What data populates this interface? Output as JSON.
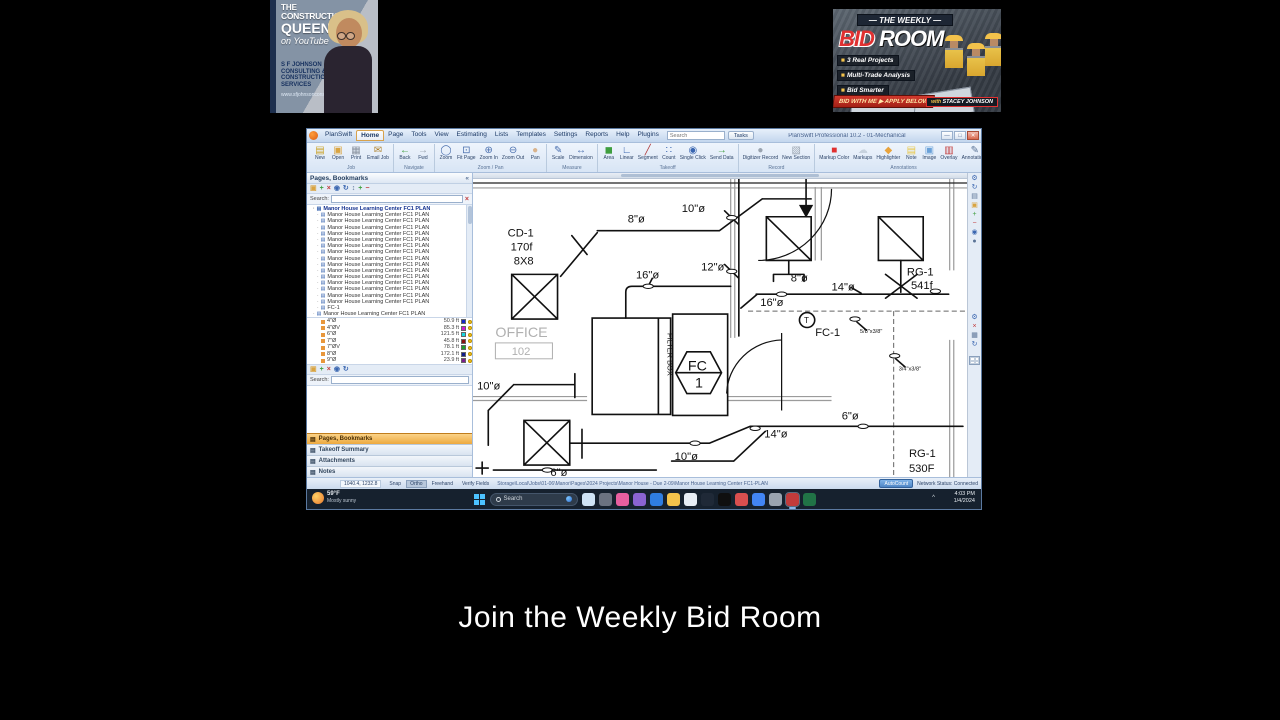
{
  "overlay": {
    "caption": "Join the Weekly Bid Room",
    "brand_card": {
      "the": "THE",
      "construction": "CONSTRUCTION",
      "queen": "QUEEN",
      "on_youtube": "on YouTube",
      "company_lines": [
        "S F JOHNSON",
        "CONSULTING &",
        "CONSTRUCTION",
        "SERVICES"
      ],
      "website": "www.sfjohnsonconsulting.com"
    },
    "banner": {
      "top": "— THE WEEKLY —",
      "title_red": "BID",
      "title_white": " ROOM",
      "bullets": [
        "3 Real Projects",
        "Multi-Trade Analysis",
        "Bid Smarter"
      ],
      "cta": "BID WITH ME  ▶ APPLY BELOW",
      "host_prefix": "with ",
      "host_name": "STACEY JOHNSON"
    }
  },
  "app": {
    "window_title": "PlanSwift Professional 10.2 - 01-Mechanical",
    "window_controls": {
      "minimize": "—",
      "maximize": "□",
      "close": "✕"
    },
    "menu": {
      "tabs": [
        "PlanSwift",
        "Home",
        "Page",
        "Tools",
        "View",
        "Estimating",
        "Lists",
        "Templates",
        "Settings",
        "Reports",
        "Help",
        "Plugins"
      ],
      "active_tab": "Home",
      "search_placeholder": "Search",
      "tasks_button": "Tasks"
    },
    "ribbon": {
      "groups": [
        {
          "label": "Job",
          "items": [
            {
              "label": "New",
              "glyph": "▤",
              "color": "#c9a227"
            },
            {
              "label": "Open",
              "glyph": "▣",
              "color": "#d9a441"
            },
            {
              "label": "Print",
              "glyph": "▦",
              "color": "#8a93a0"
            },
            {
              "label": "Email Job",
              "glyph": "✉",
              "color": "#b08430"
            }
          ]
        },
        {
          "label": "Navigate",
          "items": [
            {
              "label": "Back",
              "glyph": "←",
              "color": "#3f9e3f"
            },
            {
              "label": "Fwd",
              "glyph": "→",
              "color": "#9aa4b0"
            }
          ]
        },
        {
          "label": "Zoom / Pan",
          "items": [
            {
              "label": "Zoom",
              "glyph": "◯",
              "color": "#4a6fae"
            },
            {
              "label": "Fit Page",
              "glyph": "⊡",
              "color": "#4a6fae"
            },
            {
              "label": "Zoom In",
              "glyph": "⊕",
              "color": "#4a6fae"
            },
            {
              "label": "Zoom Out",
              "glyph": "⊖",
              "color": "#4a6fae"
            },
            {
              "label": "Pan",
              "glyph": "●",
              "color": "#d9b38c"
            }
          ]
        },
        {
          "label": "Measure",
          "items": [
            {
              "label": "Scale",
              "glyph": "✎",
              "color": "#4a6fae"
            },
            {
              "label": "Dimension",
              "glyph": "↔",
              "color": "#4a6fae"
            }
          ]
        },
        {
          "label": "Takeoff",
          "items": [
            {
              "label": "Area",
              "glyph": "◼",
              "color": "#3f9e3f"
            },
            {
              "label": "Linear",
              "glyph": "∟",
              "color": "#3a66b0"
            },
            {
              "label": "Segment",
              "glyph": "╱",
              "color": "#b03a3a"
            },
            {
              "label": "Count",
              "glyph": "∷",
              "color": "#3a66b0"
            },
            {
              "label": "Single Click",
              "glyph": "◉",
              "color": "#3a66b0"
            },
            {
              "label": "Send Data",
              "glyph": "→",
              "color": "#3f9e3f"
            }
          ]
        },
        {
          "label": "Record",
          "items": [
            {
              "label": "Digitizer Record",
              "glyph": "●",
              "color": "#9aa4b0"
            },
            {
              "label": "New Section",
              "glyph": "▧",
              "color": "#9aa4b0"
            }
          ]
        },
        {
          "label": "Annotations",
          "items": [
            {
              "label": "Markup Color",
              "glyph": "■",
              "color": "#e03030"
            },
            {
              "label": "Markups",
              "glyph": "☁",
              "color": "#c7d2de"
            },
            {
              "label": "Highlighter",
              "glyph": "◆",
              "color": "#e8a33d"
            },
            {
              "label": "Note",
              "glyph": "▤",
              "color": "#e8c84a"
            },
            {
              "label": "Image",
              "glyph": "▣",
              "color": "#6aa1d8"
            },
            {
              "label": "Overlay",
              "glyph": "▥",
              "color": "#c23b3b"
            },
            {
              "label": "Annotations",
              "glyph": "✎",
              "color": "#5a7396"
            }
          ]
        }
      ]
    },
    "sidebar": {
      "header": "Pages, Bookmarks",
      "toolbar_icons": [
        {
          "name": "folder-icon",
          "glyph": "▣",
          "color": "#d9a441"
        },
        {
          "name": "add-icon",
          "glyph": "+",
          "color": "#3f9e3f"
        },
        {
          "name": "delete-icon",
          "glyph": "×",
          "color": "#c23b3b"
        },
        {
          "name": "record-icon",
          "glyph": "◉",
          "color": "#3a66b0"
        },
        {
          "name": "refresh-icon",
          "glyph": "↻",
          "color": "#3a66b0"
        },
        {
          "name": "sort-icon",
          "glyph": "↕",
          "color": "#5a7396"
        },
        {
          "name": "expand-all-icon",
          "glyph": "+",
          "color": "#3f9e3f"
        },
        {
          "name": "collapse-all-icon",
          "glyph": "−",
          "color": "#c23b3b"
        }
      ],
      "search_label": "Search:",
      "selected_page": "Manor House Learning Center FC1 PLAN",
      "page_item_label": "Manor House Learning Center FC1 PLAN",
      "page_item_repeat": 15,
      "extra_page": "FC-1",
      "expanded_page": "Manor House Learning Center FC1 PLAN",
      "takeoff_items": [
        {
          "name": "4\"Ø",
          "qty": "50.9 ft",
          "color": "#1626c9"
        },
        {
          "name": "4\"ØV",
          "qty": "85.3 ft",
          "color": "#d019d0"
        },
        {
          "name": "6\"Ø",
          "qty": "121.5 ft",
          "color": "#17d6e0"
        },
        {
          "name": "7\"Ø",
          "qty": "45.8 ft",
          "color": "#8b1010"
        },
        {
          "name": "7\"ØV",
          "qty": "78.1 ft",
          "color": "#1f9e28"
        },
        {
          "name": "8\"Ø",
          "qty": "172.1 ft",
          "color": "#101c8c"
        },
        {
          "name": "9\"Ø",
          "qty": "23.9 ft",
          "color": "#7c1c8c"
        }
      ],
      "panels": [
        "Pages, Bookmarks",
        "Takeoff Summary",
        "Attachments",
        "Notes"
      ],
      "active_panel": "Pages, Bookmarks"
    },
    "right_toolbar": {
      "top": [
        {
          "name": "settings-icon",
          "glyph": "⚙",
          "color": "#3a66b0"
        },
        {
          "name": "refresh-icon",
          "glyph": "↻",
          "color": "#3a66b0"
        },
        {
          "name": "new-page-icon",
          "glyph": "▤",
          "color": "#5a7396"
        },
        {
          "name": "folder-icon",
          "glyph": "▣",
          "color": "#d9a441"
        },
        {
          "name": "add-icon",
          "glyph": "+",
          "color": "#3f9e3f"
        },
        {
          "name": "remove-icon",
          "glyph": "−",
          "color": "#c23b3b"
        },
        {
          "name": "record-icon",
          "glyph": "◉",
          "color": "#3a66b0"
        },
        {
          "name": "info-icon",
          "glyph": "●",
          "color": "#5a7396"
        }
      ],
      "bottom": [
        {
          "name": "settings-icon",
          "glyph": "⚙",
          "color": "#3a66b0"
        },
        {
          "name": "close-icon",
          "glyph": "×",
          "color": "#c23b3b"
        },
        {
          "name": "grid-icon",
          "glyph": "▦",
          "color": "#5a7396"
        },
        {
          "name": "refresh-icon",
          "glyph": "↻",
          "color": "#3a66b0"
        }
      ]
    },
    "statusbar": {
      "coords": "1040.4, 1232.8",
      "modes": [
        "Snap",
        "Ortho",
        "Freehand",
        "Verify Fields"
      ],
      "active_mode": "Ortho",
      "path": "Storage\\Local\\Jobs\\01-06\\Manor\\Pages\\2024 Projects\\Manor House - Due 2-09\\Manor House Learning Center FC1-PLAN",
      "autocount": "AutoCount",
      "network": "Network Status: Connected"
    },
    "plan": {
      "labels": [
        {
          "t": "10\"ø",
          "x": 205,
          "y": 33
        },
        {
          "t": "8\"ø",
          "x": 152,
          "y": 44
        },
        {
          "t": "CD-1",
          "x": 34,
          "y": 58
        },
        {
          "t": "170f",
          "x": 37,
          "y": 72
        },
        {
          "t": "8X8",
          "x": 40,
          "y": 86
        },
        {
          "t": "12\"ø",
          "x": 224,
          "y": 92
        },
        {
          "t": "16\"ø",
          "x": 160,
          "y": 100
        },
        {
          "t": "8\"ø",
          "x": 312,
          "y": 103
        },
        {
          "t": "14\"ø",
          "x": 352,
          "y": 112
        },
        {
          "t": "16\"ø",
          "x": 282,
          "y": 128
        },
        {
          "t": "RG-1",
          "x": 426,
          "y": 97
        },
        {
          "t": "541f",
          "x": 430,
          "y": 111
        },
        {
          "t": "T",
          "x": 325,
          "y": 145,
          "s": 8
        },
        {
          "t": "FC-1",
          "x": 336,
          "y": 158
        },
        {
          "t": "5/8\"x3/8\"",
          "x": 380,
          "y": 155,
          "s": 5.5
        },
        {
          "t": "OFFICE",
          "x": 22,
          "y": 159,
          "s": 14,
          "gray": 1
        },
        {
          "t": "102",
          "x": 38,
          "y": 177,
          "s": 11,
          "gray": 1
        },
        {
          "t": "FILTER BOX",
          "x": 191,
          "y": 155,
          "s": 7.5,
          "rot": 90
        },
        {
          "t": "FC",
          "x": 211,
          "y": 193,
          "s": 14
        },
        {
          "t": "1",
          "x": 218,
          "y": 210,
          "s": 14
        },
        {
          "t": "10\"ø",
          "x": 4,
          "y": 212
        },
        {
          "t": "10\"ø",
          "x": 198,
          "y": 283
        },
        {
          "t": "6\"ø",
          "x": 76,
          "y": 299
        },
        {
          "t": "14\"ø",
          "x": 286,
          "y": 260
        },
        {
          "t": "6\"ø",
          "x": 362,
          "y": 242
        },
        {
          "t": "3/4\"x3/8\"",
          "x": 418,
          "y": 193,
          "s": 5.5
        },
        {
          "t": "RG-1",
          "x": 428,
          "y": 280
        },
        {
          "t": "530F",
          "x": 428,
          "y": 295
        }
      ]
    }
  },
  "taskbar": {
    "weather": {
      "temp": "59°F",
      "condition": "Mostly sunny"
    },
    "search_placeholder": "Search",
    "icons": [
      {
        "name": "copilot-icon",
        "color": "#cfe3f5"
      },
      {
        "name": "snip-icon",
        "color": "#6b7280"
      },
      {
        "name": "photos-icon",
        "color": "#e85fa0"
      },
      {
        "name": "store-icon",
        "color": "#8a63d2"
      },
      {
        "name": "edge-icon",
        "color": "#2f7de1"
      },
      {
        "name": "explorer-icon",
        "color": "#f3c24b"
      },
      {
        "name": "app-icon",
        "color": "#e8eef5"
      },
      {
        "name": "notepad-icon",
        "color": "#1f2937"
      },
      {
        "name": "tiktok-icon",
        "color": "#0f0f0f"
      },
      {
        "name": "media-icon",
        "color": "#d94f4f"
      },
      {
        "name": "chrome-icon",
        "color": "#4285f4"
      },
      {
        "name": "steam-icon",
        "color": "#9aa4b0"
      },
      {
        "name": "planswift-icon",
        "color": "#c23b3b"
      },
      {
        "name": "excel-icon",
        "color": "#217346"
      }
    ],
    "active_icon": "planswift-icon",
    "tray_glyph": "^",
    "clock": {
      "time": "4:03 PM",
      "date": "1/4/2024"
    }
  }
}
